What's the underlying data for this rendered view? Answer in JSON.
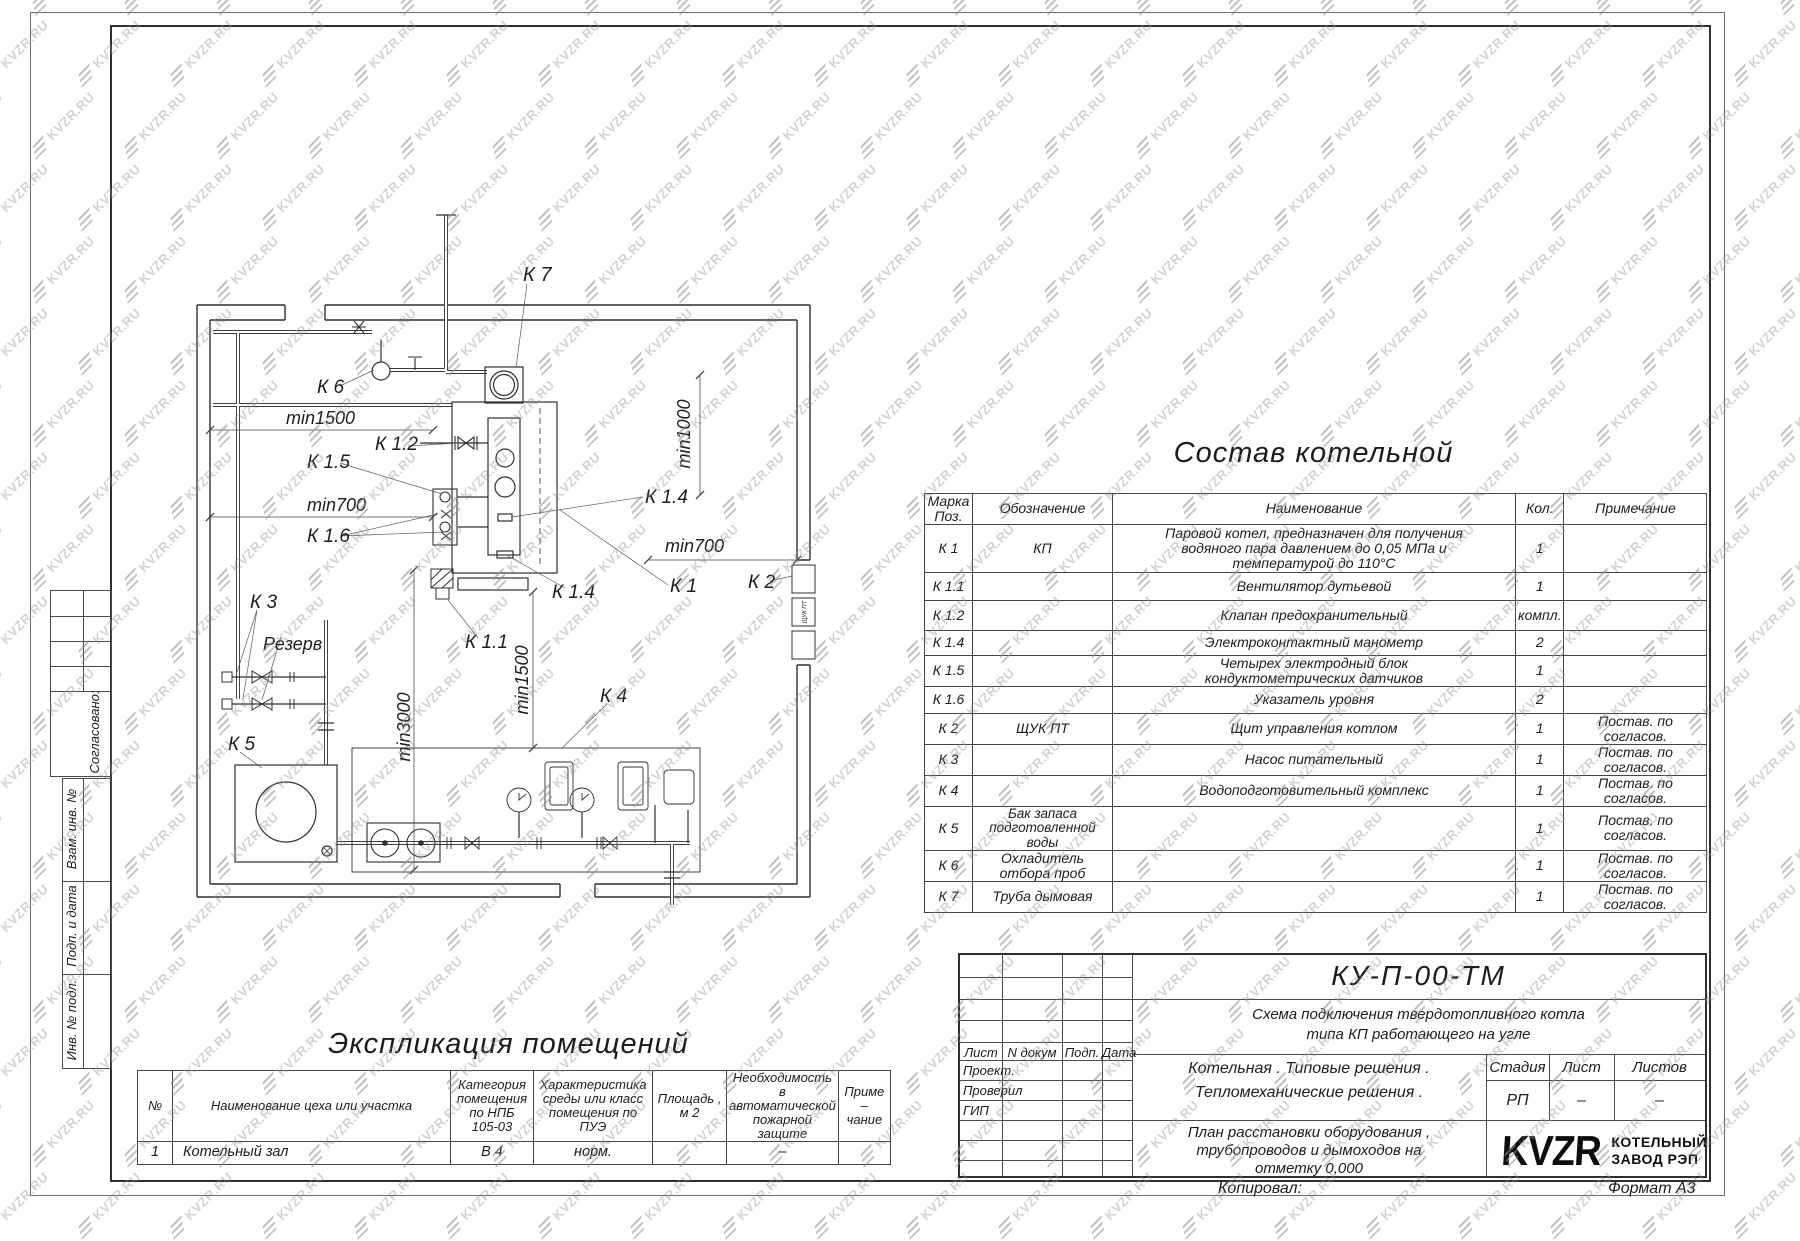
{
  "watermark": {
    "text": "KVZR.RU"
  },
  "sidebar": {
    "soglasovano": "Согласовано:",
    "vzam": "Взам. инв. №",
    "podp_data": "Подп. и дата",
    "inv_podl": "Инв. № подл."
  },
  "plan": {
    "labels": {
      "k7": "К 7",
      "k6": "К 6",
      "min1500_top": "min1500",
      "k12": "К 1.2",
      "k15": "К 1.5",
      "min700_left": "min700",
      "k16": "К 1.6",
      "min1000": "min1000",
      "k14_right": "К 1.4",
      "min700_right": "min700",
      "k1": "К 1",
      "k2": "К 2",
      "k14_bottom": "К 1.4",
      "k11": "К 1.1",
      "min1500_vert": "min1500",
      "k4": "К 4",
      "min3000": "min3000",
      "k3": "К 3",
      "rezerv": "Резерв",
      "k5": "К 5",
      "wall_box": "ЩУК ПТ"
    }
  },
  "equipment_table": {
    "title": "Состав котельной",
    "headers": [
      "Марка\nПоз.",
      "Обозначение",
      "Наименование",
      "Кол.",
      "Примечание"
    ],
    "rows": [
      {
        "mark": "К 1",
        "designation": "КП",
        "name": "Паровой котел, предназначен для получения\nводяного пара давлением до  0,05  МПа и\nтемпературой до  110°С",
        "qty": "1",
        "note": ""
      },
      {
        "mark": "К 1.1",
        "designation": "",
        "name": "Вентилятор дутьевой",
        "qty": "1",
        "note": ""
      },
      {
        "mark": "К 1.2",
        "designation": "",
        "name": "Клапан предохранительный",
        "qty": "компл.",
        "note": ""
      },
      {
        "mark": "К 1.4",
        "designation": "",
        "name": "Электроконтактный манометр",
        "qty": "2",
        "note": ""
      },
      {
        "mark": "К 1.5",
        "designation": "",
        "name": "Четырех электродный блок\nкондуктометрических датчиков",
        "qty": "1",
        "note": ""
      },
      {
        "mark": "К 1.6",
        "designation": "",
        "name": "Указатель уровня",
        "qty": "2",
        "note": ""
      },
      {
        "mark": "К 2",
        "designation": "ЩУК ПТ",
        "name": "Щит управления котлом",
        "qty": "1",
        "note": "Постав. по согласов."
      },
      {
        "mark": "К 3",
        "designation": "",
        "name": "Насос питательный",
        "qty": "1",
        "note": "Постав. по согласов."
      },
      {
        "mark": "К 4",
        "designation": "",
        "name": "Водоподготовительный комплекс",
        "qty": "1",
        "note": "Постав. по согласов."
      },
      {
        "mark": "К 5",
        "designation": "Бак запаса подготовленной\nводы",
        "name": "",
        "qty": "1",
        "note": "Постав. по согласов."
      },
      {
        "mark": "К 6",
        "designation": "Охладитель отбора проб",
        "name": "",
        "qty": "1",
        "note": "Постав. по согласов."
      },
      {
        "mark": "К 7",
        "designation": "Труба дымовая",
        "name": "",
        "qty": "1",
        "note": "Постав. по согласов."
      }
    ]
  },
  "explication_table": {
    "title": "Экспликация помещений",
    "headers": [
      "№",
      "Наименование цеха или участка",
      "Категория\nпомещения\nпо НПБ\n105-03",
      "Характеристика\nсреды или класс\nпомещения по\nПУЭ",
      "Площадь ,\nм 2",
      "Необходимость в\nавтоматической\nпожарной защите",
      "Приме –\nчание"
    ],
    "rows": [
      [
        "1",
        "Котельный зал",
        "В 4",
        "норм.",
        "",
        "–",
        ""
      ]
    ]
  },
  "title_block": {
    "doc_number": "КУ-П-00-ТМ",
    "doc_title_line1": "Схема  подключения  твердотопливного  котла",
    "doc_title_line2": "типа  КП  работающего  на  угле",
    "left_headers": [
      "Лист",
      "N докум",
      "Подп.",
      "Дата"
    ],
    "roles": [
      "Проект.",
      "Проверил",
      "ГИП"
    ],
    "section_line1": "Котельная . Типовые решения .",
    "section_line2": "Тепломеханические решения .",
    "stage_label": "Стадия",
    "sheet_label": "Лист",
    "sheets_label": "Листов",
    "stage_value": "РП",
    "sheet_value": "–",
    "sheets_value": "–",
    "drawing_name_line1": "План расстановки оборудования ,",
    "drawing_name_line2": "трубопроводов и дымоходов на",
    "drawing_name_line3": "отметку  0,000",
    "logo_text": "KVZR",
    "logo_caption_line1": "КОТЕЛЬНЫЙ",
    "logo_caption_line2": "ЗАВОД РЭП",
    "copied_label": "Копировал:",
    "format_label": "Формат А3"
  }
}
